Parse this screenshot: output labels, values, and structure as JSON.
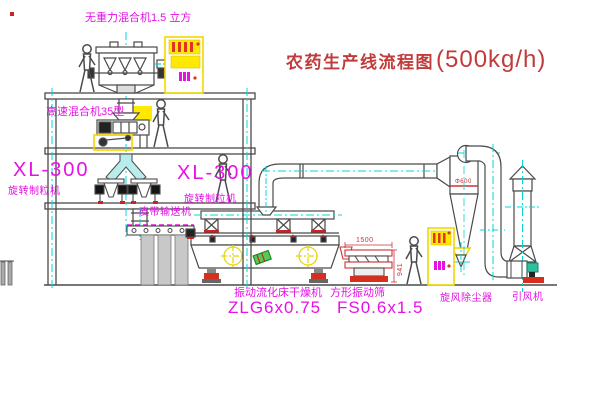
{
  "title": {
    "text": "农药生产线流程图",
    "capacity": "(500kg/h)"
  },
  "labels": {
    "gravity_mixer": "无重力混合机1.5 立方",
    "high_speed_mixer": "高速混合机35型",
    "granulator_left_model": "XL-300",
    "granulator_left_name": "旋转制粒机",
    "granulator_right_model": "XL-300",
    "granulator_right_name": "旋转制粒机",
    "belt_conveyor": "皮带输送机",
    "dryer_name": "振动流化床干燥机",
    "dryer_model": "ZLG6x0.75",
    "screen_name": "方形振动筛",
    "screen_model": "FS0.6x1.5",
    "cyclone_name": "旋风除尘器",
    "fan_name": "引风机"
  },
  "dimensions": {
    "screen_length": "1500",
    "screen_height": "941",
    "cyclone_diameter": "Φ600"
  },
  "colors": {
    "line_gray": "#4a4a4a",
    "centerline_cyan": "#00d8d8",
    "label_magenta": "#e511e5",
    "annotation_red": "#cc3333",
    "highlight_yellow": "#ffe800",
    "machine_green": "#2fbf9f"
  }
}
